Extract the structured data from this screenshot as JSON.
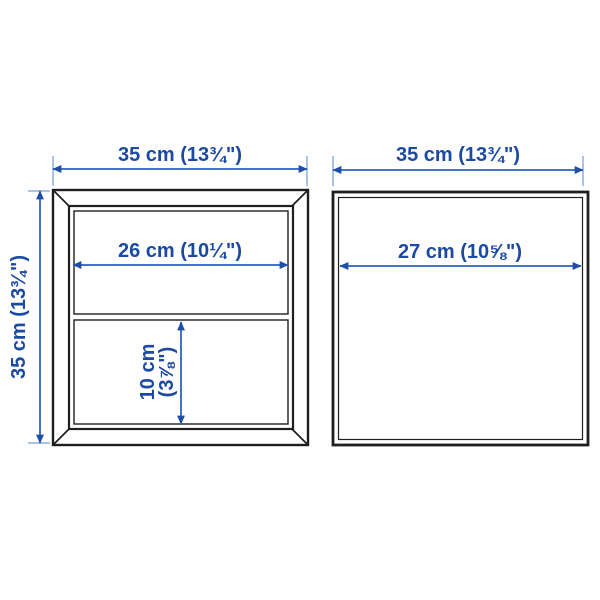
{
  "diagram": {
    "type": "product-dimension-diagram",
    "left_figure": {
      "name": "cabinet-with-shelf",
      "width_label": "35 cm (13¾\")",
      "height_label": "35 cm (13¾\")",
      "inner_width_label": "26 cm (10¼\")",
      "inner_height_label_line1": "10 cm",
      "inner_height_label_line2": "(3⅞\")"
    },
    "right_figure": {
      "name": "open-cabinet",
      "width_label": "35 cm (13¾\")",
      "inner_width_label": "27 cm (10⅝\")"
    },
    "colors": {
      "background": "#ffffff",
      "outline": "#1f1f1f",
      "dimension_text": "#1c4aa2",
      "dimension_line": "#4472c8",
      "arrowhead": "#1e4ea8",
      "extension_tick": "#a9c3e6"
    }
  }
}
